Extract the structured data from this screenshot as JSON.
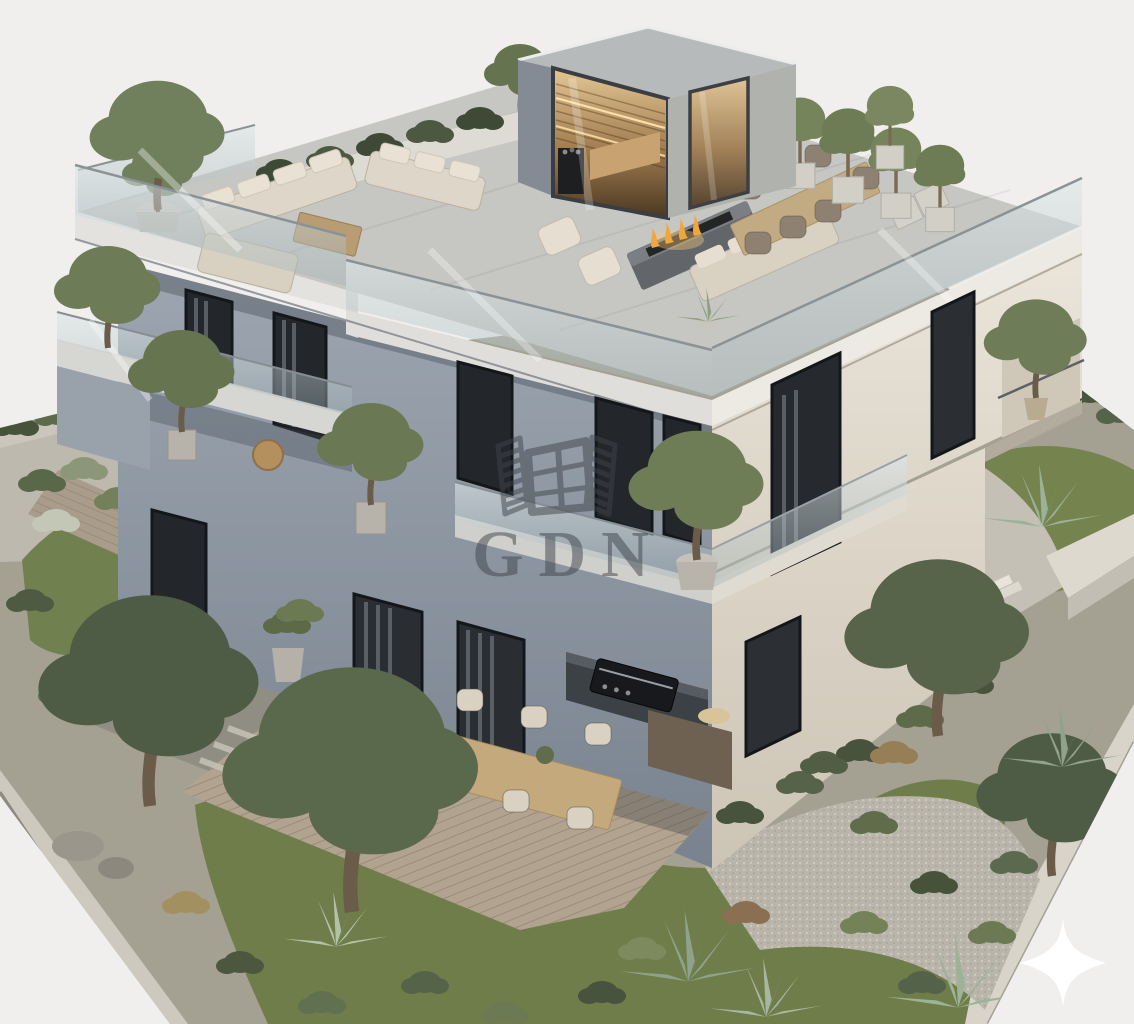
{
  "image": {
    "kind": "architectural-3d-rendering",
    "description": "Aerial corner view of a modern flat-roof villa with rooftop terrace, glass balustrades, wooden deck and landscaped garden on a white background"
  },
  "watermark": {
    "text": "GDN",
    "logo_icon": "open-window-with-shutters-icon",
    "color": "#3f444b",
    "opacity": "0.5"
  },
  "overlay": {
    "sparkle_icon": "four-point-sparkle-icon",
    "sparkle_color": "#ffffff"
  },
  "palette": {
    "background": "#f0efed",
    "wall_shadow_side": "#97a0aa",
    "wall_light_side": "#e6e0d5",
    "roof_deck": "#c6c7c3",
    "glass": "#c3ced0",
    "deck_wood": "#b2a391",
    "lawn": "#6f7d4b",
    "shrub_dark": "#4b573f",
    "gravel": "#b9b5aa",
    "fire": "#f0a63e",
    "sauna_glow": "#c49a66"
  },
  "scene": {
    "elements": [
      "rooftop-terrace",
      "sauna-cabin",
      "lounge-sofas",
      "fire-pit-table",
      "rooftop-dining-set",
      "potted-olive-trees",
      "glass-balustrade",
      "balconies",
      "wooden-deck",
      "outdoor-dining-set",
      "bbq-grill-station",
      "garden-olive-trees",
      "agave-plants",
      "gravel-paths",
      "lawn",
      "boundary-walls"
    ]
  }
}
